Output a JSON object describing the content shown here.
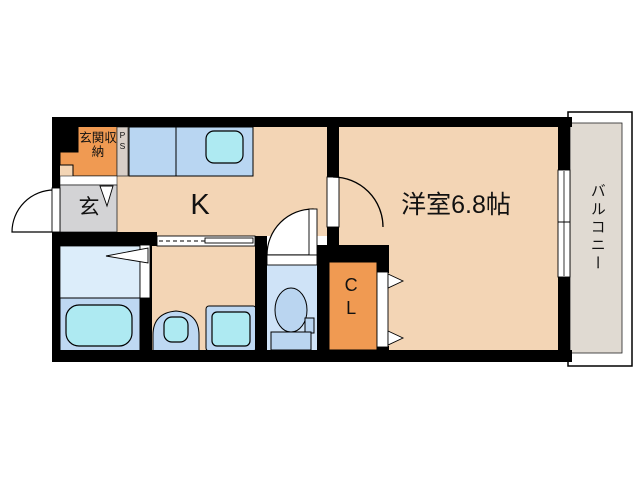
{
  "title": "1K apartment floor plan",
  "labels": {
    "entrance_storage": "玄関収納",
    "pipe_space": "PS",
    "entrance": "玄",
    "kitchen": "K",
    "western_room": "洋室6.8帖",
    "closet": "CL",
    "balcony": "バルコニー"
  },
  "colors": {
    "wall": "#000000",
    "floor": "#f3d5b5",
    "accent_orange": "#f09a52",
    "entrance_gray": "#d3d3d5",
    "ps_gray": "#d8cfc8",
    "counter_blue": "#b9d6f2",
    "fixture_cyan": "#aeeaf2",
    "bath_light": "#dcedfa",
    "bath_mid": "#bed8f2",
    "toilet_room": "#cfe3f7",
    "toilet_fixture": "#bad5f0",
    "balcony_floor": "#e0dad2"
  }
}
